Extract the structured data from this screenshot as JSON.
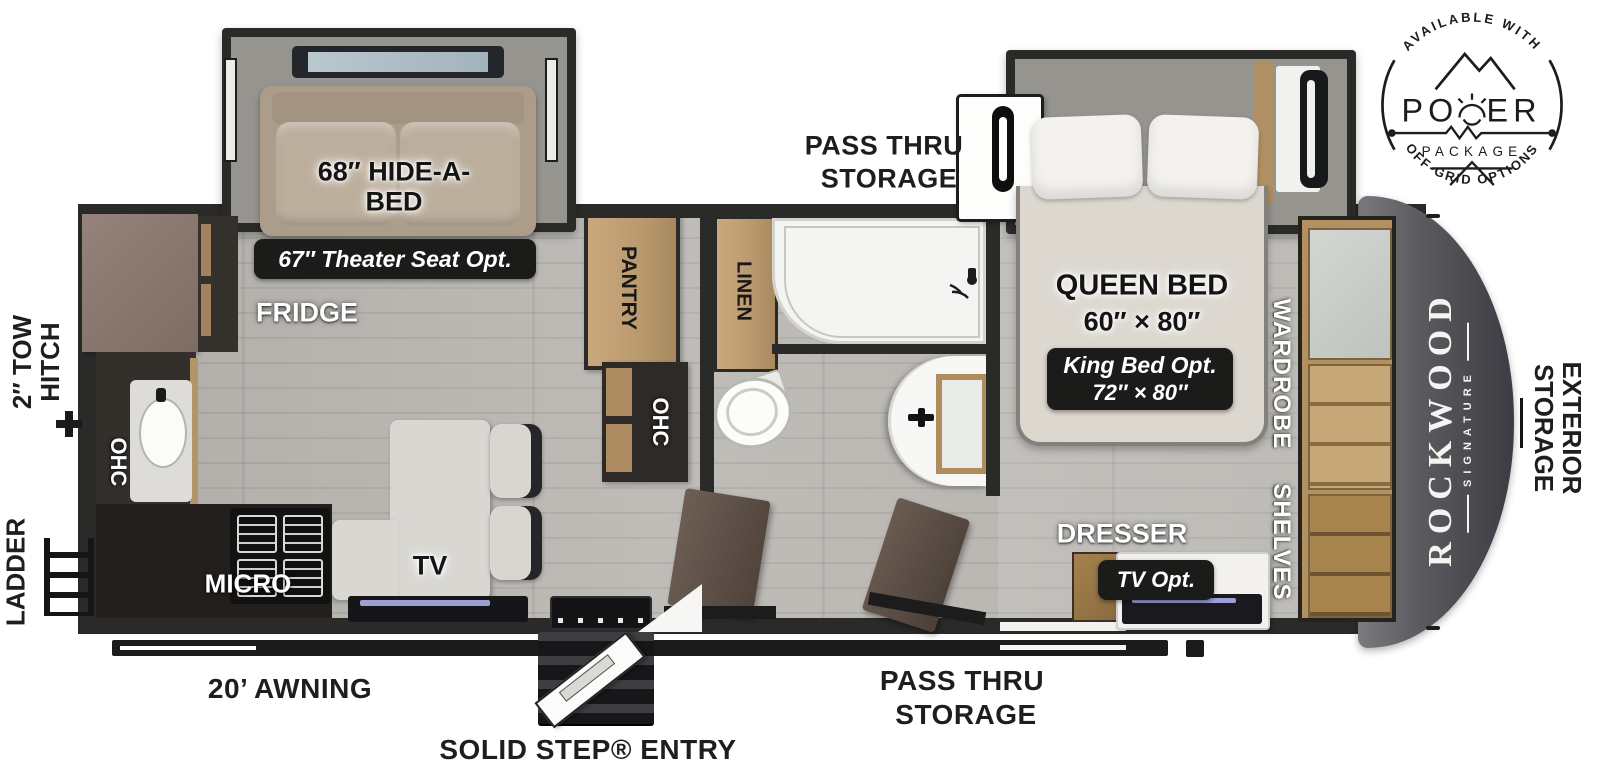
{
  "power_badge": {
    "arc_top": "AVAILABLE WITH",
    "word_left": "PO",
    "word_right": "ER",
    "package": "PACKAGE",
    "arc_bottom": "OFF-GRID OPTIONS"
  },
  "exterior": {
    "tow_hitch_line1": "2″ TOW",
    "tow_hitch_line2": "HITCH",
    "ladder": "LADDER",
    "awning": "20’ AWNING",
    "entry": "SOLID STEP® ENTRY",
    "pass_thru_bottom_line1": "PASS THRU",
    "pass_thru_bottom_line2": "STORAGE",
    "pass_thru_top_line1": "PASS THRU",
    "pass_thru_top_line2": "STORAGE",
    "exterior_storage_line1": "EXTERIOR",
    "exterior_storage_line2": "STORAGE"
  },
  "brand": {
    "name": "ROCKWOOD",
    "series": "SIGNATURE"
  },
  "living": {
    "hide_a_bed_line1": "68″ HIDE-A-",
    "hide_a_bed_line2": "BED",
    "theater_opt": "67″ Theater Seat Opt.",
    "fridge": "FRIDGE",
    "ohc_kitchen": "OHC",
    "micro": "MICRO",
    "tv": "TV",
    "pantry": "PANTRY",
    "ohc_hall": "OHC",
    "linen": "LINEN"
  },
  "bedroom": {
    "queen_line1": "QUEEN BED",
    "queen_line2": "60″ × 80″",
    "king_line1": "King Bed Opt.",
    "king_line2": "72″ × 80″",
    "wardrobe": "WARDROBE",
    "shelves": "SHELVES",
    "dresser": "DRESSER",
    "tv_opt": "TV Opt."
  }
}
